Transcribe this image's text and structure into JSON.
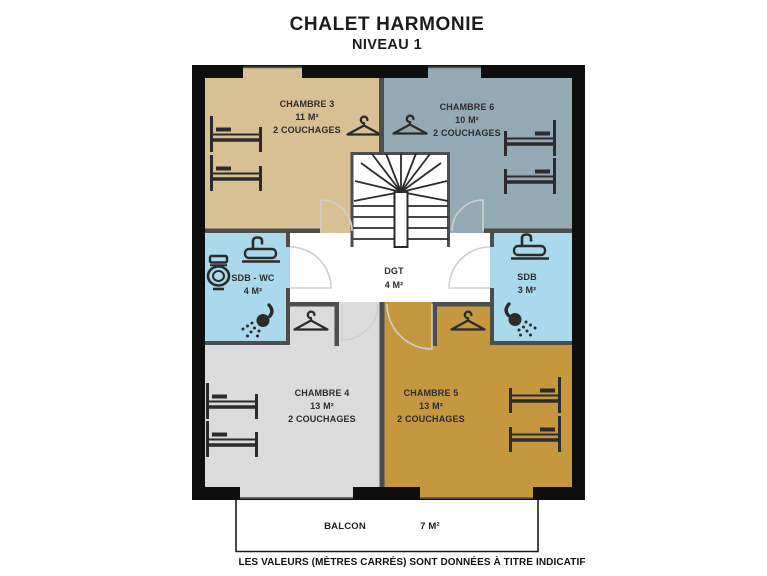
{
  "title": {
    "main": "CHALET HARMONIE",
    "subtitle": "NIVEAU 1"
  },
  "footnote": "LES VALEURS (MÈTRES CARRÉS) SONT DONNÉES À TITRE INDICATIF",
  "balcony": {
    "name": "BALCON",
    "area": "7 M²"
  },
  "rooms": [
    {
      "id": "chambre-3",
      "name": "CHAMBRE 3",
      "area": "11 M²",
      "capacity": "2 COUCHAGES",
      "color": "#d7c094"
    },
    {
      "id": "chambre-6",
      "name": "CHAMBRE 6",
      "area": "10 M²",
      "capacity": "2 COUCHAGES",
      "color": "#93a9b4"
    },
    {
      "id": "sdb-wc",
      "name": "SDB - WC",
      "area": "4 M²",
      "color": "#a9d9ea"
    },
    {
      "id": "dgt",
      "name": "DGT",
      "area": "4 M²",
      "color": "#ffffff"
    },
    {
      "id": "sdb",
      "name": "SDB",
      "area": "3 M²",
      "color": "#a9d9ea"
    },
    {
      "id": "chambre-4",
      "name": "CHAMBRE 4",
      "area": "13 M²",
      "capacity": "2 COUCHAGES",
      "color": "#dbdbdb"
    },
    {
      "id": "chambre-5",
      "name": "CHAMBRE 5",
      "area": "13 M²",
      "capacity": "2 COUCHAGES",
      "color": "#c5973f"
    }
  ],
  "icons": {
    "bed": "bed-icon",
    "hanger": "hanger-icon",
    "sink": "sink-icon",
    "toilet": "toilet-icon",
    "shower": "shower-icon",
    "stairs": "stairs-icon"
  }
}
